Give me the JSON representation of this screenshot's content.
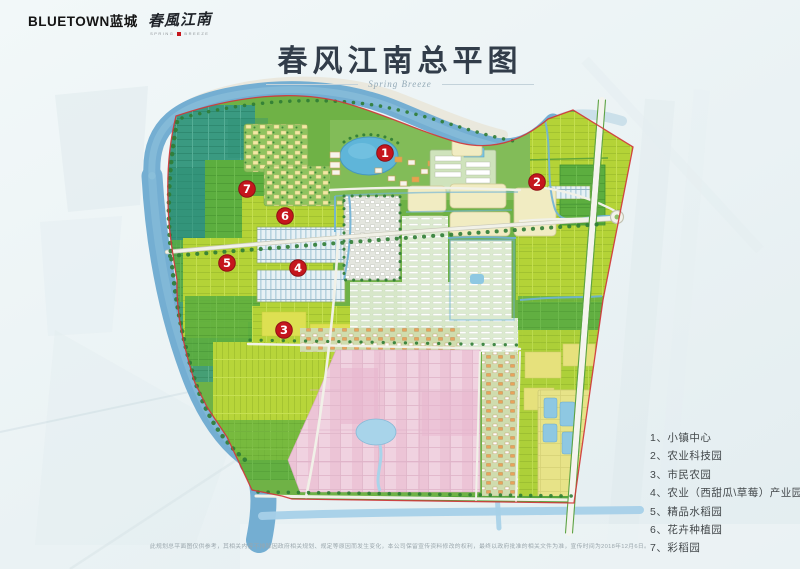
{
  "header": {
    "brand_wordmark": "BLUETOWN蓝城",
    "brand_script": "春風江南",
    "brand_tagline_left": "SPRING",
    "brand_tagline_right": "BREEZE"
  },
  "title": {
    "text": "春风江南总平图",
    "script": "Spring Breeze"
  },
  "legend": {
    "items": [
      "1、小镇中心",
      "2、农业科技园",
      "3、市民农园",
      "4、农业（西甜瓜\\草莓）产业园",
      "5、精品水稻园",
      "6、花卉种植园",
      "7、彩稻园"
    ]
  },
  "markers": [
    {
      "num": "1",
      "label": "小镇中心"
    },
    {
      "num": "2",
      "label": "农业科技园"
    },
    {
      "num": "3",
      "label": "市民农园"
    },
    {
      "num": "4",
      "label": "农业（西甜瓜\\草莓）产业园"
    },
    {
      "num": "5",
      "label": "精品水稻园"
    },
    {
      "num": "6",
      "label": "花卉种植园"
    },
    {
      "num": "7",
      "label": "彩稻园"
    }
  ],
  "disclaimer": "此规划总平面图仅供参考，其相关内容不排除因政府相关规划、规定等原因而发生变化，本公司保留宣传资料修改的权利，最终以政府批准的相关文件为准，宣传时间为2018年12月6日。",
  "colors": {
    "marker_red": "#c5161d",
    "boundary_red": "#d2353a",
    "river_blue": "#74aed2",
    "field_green": "#6fb246",
    "paddy_yellow_green": "#b4d337",
    "pink_paddy": "#f0d2e0",
    "title_ink": "#323d4a",
    "background": "#e9f1f3"
  }
}
